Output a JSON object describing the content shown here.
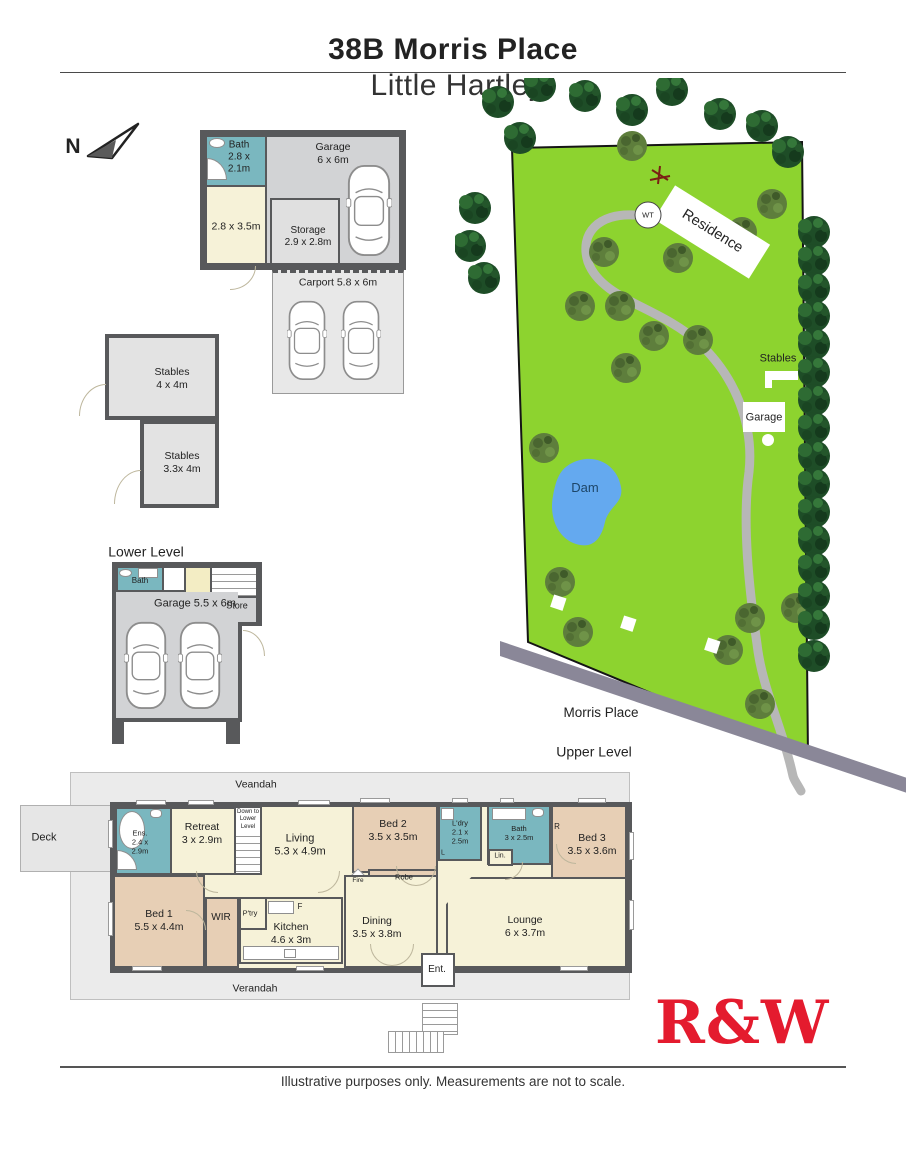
{
  "header": {
    "address_bold": "38B Morris Place",
    "suburb_light": "Little Hartley"
  },
  "compass": {
    "label": "N"
  },
  "outbuilding": {
    "bath": "Bath\n2.8 x\n2.1m",
    "garage": "Garage\n6 x 6m",
    "room": "2.8 x 3.5m",
    "storage": "Storage\n2.9 x 2.8m",
    "carport": "Carport 5.8 x 6m"
  },
  "stables": {
    "stable_top": "Stables\n4 x 4m",
    "stable_bottom": "Stables\n3.3x 4m"
  },
  "lower": {
    "heading": "Lower Level",
    "bath": "Bath",
    "garage": "Garage 5.5 x 6m",
    "store": "Store"
  },
  "site": {
    "water_tank": "WT",
    "residence": "Residence",
    "stables": "Stables",
    "garage": "Garage",
    "dam": "Dam",
    "road": "Morris Place"
  },
  "upper": {
    "heading": "Upper Level",
    "verandah_top": "Veandah",
    "verandah_bottom": "Verandah",
    "deck": "Deck",
    "ens": "Ens.\n2.4 x\n2.9m",
    "retreat": "Retreat\n3 x 2.9m",
    "stairs": "Down to\nLower\nLevel",
    "living": "Living\n5.3 x 4.9m",
    "bed2": "Bed 2\n3.5 x 3.5m",
    "robe": "Robe",
    "fire": "Fire",
    "ldry": "L'dry\n2.1 x\n2.5m",
    "l_short": "L",
    "bath": "Bath\n3 x 2.5m",
    "lin": "Lin.",
    "r_short": "R",
    "bed3": "Bed 3\n3.5 x 3.6m",
    "bed1": "Bed 1\n5.5 x 4.4m",
    "wir": "WIR",
    "ptry": "P'try",
    "fridge": "F",
    "kitchen": "Kitchen\n4.6 x 3m",
    "dining": "Dining\n3.5 x 3.8m",
    "ent": "Ent.",
    "lounge": "Lounge\n6 x 3.7m"
  },
  "branding": {
    "logo": "R&W"
  },
  "footer": {
    "disclaimer": "Illustrative purposes only. Measurements are not to scale."
  },
  "colors": {
    "accent_red": "#E41B2E",
    "land_green": "#8DD32F",
    "dam_blue": "#64A9EF",
    "room_cream": "#F6F2D8",
    "room_tan": "#E7CFB5",
    "room_wet": "#7AB7BF",
    "wall": "#58595B",
    "road": "#8A8798",
    "driveway": "#B7B7B7"
  }
}
